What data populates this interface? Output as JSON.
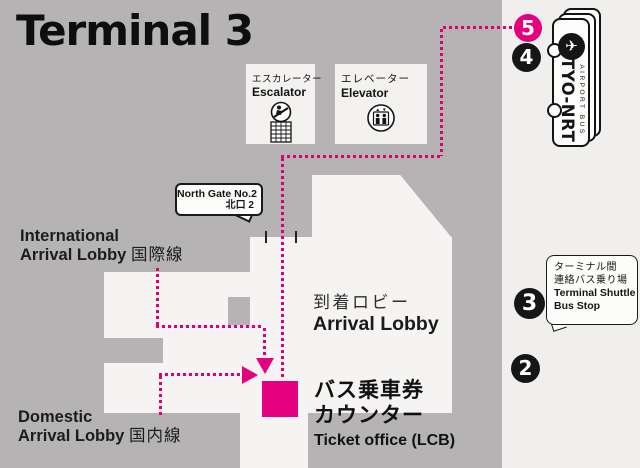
{
  "title": "Terminal 3",
  "colors": {
    "map_bg": "#b5b3b4",
    "panel_bg": "#f0efed",
    "building": "#f5f4f2",
    "accent_magenta": "#e4007f",
    "text_black": "#1a1a1a"
  },
  "facilities": {
    "escalator": {
      "label_ja": "エスカレーター",
      "label_en": "Escalator",
      "icon": "escalator-icon"
    },
    "elevator": {
      "label_ja": "エレベーター",
      "label_en": "Elevator",
      "icon": "elevator-icon"
    }
  },
  "gate_callout": {
    "line1": "North Gate No.2",
    "line2": "北口 2"
  },
  "areas": {
    "international": {
      "line1": "International",
      "line2": "Arrival Lobby ",
      "line2_ja": "国際線"
    },
    "domestic": {
      "line1": "Domestic",
      "line2": "Arrival Lobby ",
      "line2_ja": "国内線"
    },
    "arrival_lobby": {
      "ja": "到着ロビー",
      "en": "Arrival Lobby"
    },
    "ticket_office": {
      "ja1": "バス乗車券",
      "ja2": "カウンター",
      "en": "Ticket office (LCB)"
    }
  },
  "shuttle_callout": {
    "ja1": "ターミナル間",
    "ja2": "連絡バス乗り場",
    "en1": "Terminal Shuttle",
    "en2": "Bus Stop"
  },
  "bus_stops": [
    {
      "number": "5",
      "color": "#e4007f"
    },
    {
      "number": "4",
      "color": "#161616"
    },
    {
      "number": "3",
      "color": "#161616"
    },
    {
      "number": "2",
      "color": "#161616"
    }
  ],
  "ticket_logo": {
    "brand": "TYO-NRT",
    "sub": "AIRPORT BUS",
    "icon": "airplane-icon",
    "plane_glyph": "✈"
  }
}
